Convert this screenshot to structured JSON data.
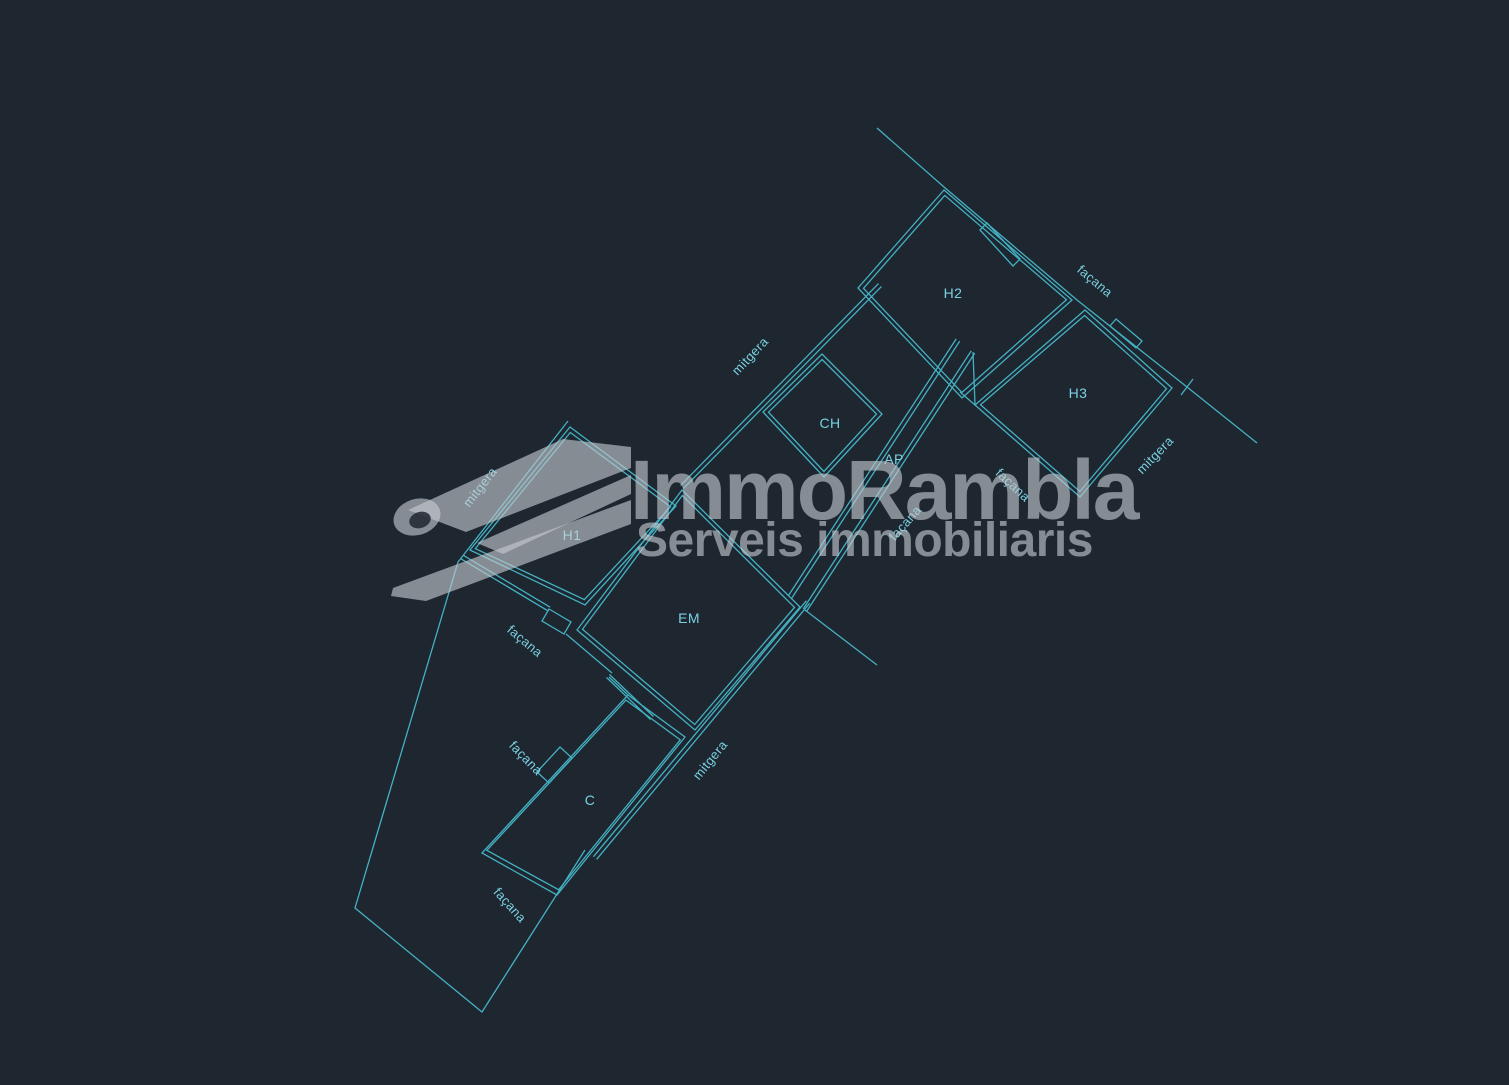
{
  "drawing": {
    "kind": "cad-floor-plan",
    "colors": {
      "background": "#1e2630",
      "line": "#44b1c2",
      "label_text": "#7ad2e2",
      "watermark": "#90969e"
    }
  },
  "annotations": [
    {
      "text": "H2",
      "kind": "room"
    },
    {
      "text": "H3",
      "kind": "room"
    },
    {
      "text": "CH",
      "kind": "room"
    },
    {
      "text": "AP",
      "kind": "room"
    },
    {
      "text": "H1",
      "kind": "room"
    },
    {
      "text": "EM",
      "kind": "room"
    },
    {
      "text": "C",
      "kind": "room"
    },
    {
      "text": "façana",
      "kind": "wall"
    },
    {
      "text": "mitgera",
      "kind": "wall"
    },
    {
      "text": "mitgera",
      "kind": "wall"
    },
    {
      "text": "façana",
      "kind": "wall"
    },
    {
      "text": "façana",
      "kind": "wall"
    },
    {
      "text": "façana",
      "kind": "wall"
    },
    {
      "text": "façana",
      "kind": "wall"
    },
    {
      "text": "façana",
      "kind": "wall"
    },
    {
      "text": "mitgera",
      "kind": "wall"
    },
    {
      "text": "mitgera",
      "kind": "wall"
    }
  ],
  "watermark": {
    "title": "ImmoRambla",
    "subtitle": "Serveis immobiliaris"
  }
}
